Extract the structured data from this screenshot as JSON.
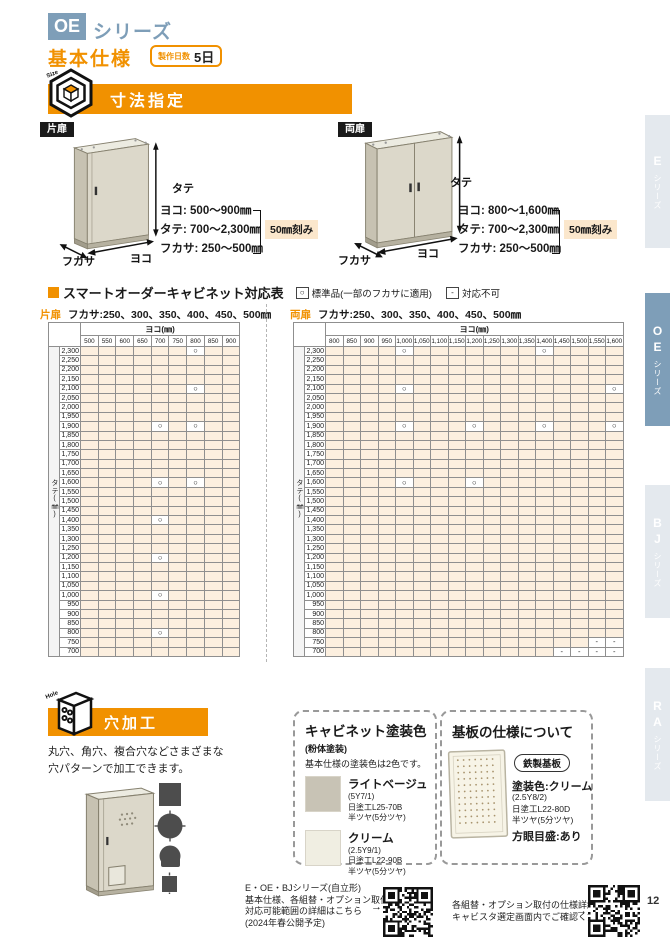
{
  "page": {
    "series_code": "OE",
    "series_suffix": "シリーズ",
    "section_title": "基本仕様",
    "lead_time_label": "製作日数",
    "lead_time_value": "5日",
    "page_number": "12"
  },
  "sidebar": {
    "tabs": [
      {
        "series": "E",
        "suffix": "シリーズ",
        "active": false
      },
      {
        "series": "OE",
        "suffix": "シリーズ",
        "active": true
      },
      {
        "series": "BJ",
        "suffix": "シリーズ",
        "active": false
      },
      {
        "series": "RA",
        "suffix": "シリーズ",
        "active": false
      }
    ]
  },
  "dimension_section": {
    "title": "寸法指定",
    "icon_label": "Size",
    "dim_labels": {
      "height": "タテ",
      "width": "ヨコ",
      "depth": "フカサ"
    },
    "single_door": {
      "label": "片扉",
      "specs": [
        "ヨコ: 500〜900㎜",
        "タテ: 700〜2,300㎜",
        "フカサ: 250〜500㎜"
      ],
      "step_note": "50㎜刻み"
    },
    "double_door": {
      "label": "両扉",
      "specs": [
        "ヨコ: 800〜1,600㎜",
        "タテ: 700〜2,300㎜",
        "フカサ: 250〜500㎜"
      ],
      "step_note": "50㎜刻み"
    }
  },
  "compatibility": {
    "title": "スマートオーダーキャビネット対応表",
    "legend": [
      {
        "symbol": "○",
        "label": "標準品(一部のフカサに適用)"
      },
      {
        "symbol": "-",
        "label": "対応不可"
      }
    ],
    "col_axis_label": "ヨコ(㎜)",
    "row_axis_label": "タテ(㎜)",
    "rows": [
      "2,300",
      "2,250",
      "2,200",
      "2,150",
      "2,100",
      "2,050",
      "2,000",
      "1,950",
      "1,900",
      "1,850",
      "1,800",
      "1,750",
      "1,700",
      "1,650",
      "1,600",
      "1,550",
      "1,500",
      "1,450",
      "1,400",
      "1,350",
      "1,300",
      "1,250",
      "1,200",
      "1,150",
      "1,100",
      "1,050",
      "1,000",
      "950",
      "900",
      "850",
      "800",
      "750",
      "700"
    ],
    "tables": [
      {
        "door_label": "片扉",
        "depth_note": "フカサ:250、300、350、400、450、500㎜",
        "columns": [
          "500",
          "550",
          "600",
          "650",
          "700",
          "750",
          "800",
          "850",
          "900"
        ],
        "marks": [
          {
            "r": "2,300",
            "c": "800",
            "s": "○"
          },
          {
            "r": "2,100",
            "c": "800",
            "s": "○"
          },
          {
            "r": "1,900",
            "c": "700",
            "s": "○"
          },
          {
            "r": "1,900",
            "c": "800",
            "s": "○"
          },
          {
            "r": "1,600",
            "c": "700",
            "s": "○"
          },
          {
            "r": "1,600",
            "c": "800",
            "s": "○"
          },
          {
            "r": "1,400",
            "c": "700",
            "s": "○"
          },
          {
            "r": "1,200",
            "c": "700",
            "s": "○"
          },
          {
            "r": "1,000",
            "c": "700",
            "s": "○"
          },
          {
            "r": "800",
            "c": "700",
            "s": "○"
          }
        ]
      },
      {
        "door_label": "両扉",
        "depth_note": "フカサ:250、300、350、400、450、500㎜",
        "columns": [
          "800",
          "850",
          "900",
          "950",
          "1,000",
          "1,050",
          "1,100",
          "1,150",
          "1,200",
          "1,250",
          "1,300",
          "1,350",
          "1,400",
          "1,450",
          "1,500",
          "1,550",
          "1,600"
        ],
        "marks": [
          {
            "r": "2,300",
            "c": "1,000",
            "s": "○"
          },
          {
            "r": "2,300",
            "c": "1,400",
            "s": "○"
          },
          {
            "r": "2,100",
            "c": "1,000",
            "s": "○"
          },
          {
            "r": "2,100",
            "c": "1,600",
            "s": "○"
          },
          {
            "r": "1,900",
            "c": "1,000",
            "s": "○"
          },
          {
            "r": "1,900",
            "c": "1,200",
            "s": "○"
          },
          {
            "r": "1,900",
            "c": "1,400",
            "s": "○"
          },
          {
            "r": "1,900",
            "c": "1,600",
            "s": "○"
          },
          {
            "r": "1,600",
            "c": "1,000",
            "s": "○"
          },
          {
            "r": "1,600",
            "c": "1,200",
            "s": "○"
          },
          {
            "r": "750",
            "c": "1,550",
            "s": "-"
          },
          {
            "r": "750",
            "c": "1,600",
            "s": "-"
          },
          {
            "r": "700",
            "c": "1,450",
            "s": "-"
          },
          {
            "r": "700",
            "c": "1,500",
            "s": "-"
          },
          {
            "r": "700",
            "c": "1,550",
            "s": "-"
          },
          {
            "r": "700",
            "c": "1,600",
            "s": "-"
          }
        ]
      }
    ]
  },
  "hole_section": {
    "title": "穴加工",
    "icon_label": "Hole",
    "description_lines": [
      "丸穴、角穴、複合穴などさまざまな",
      "穴パターンで加工できます。"
    ]
  },
  "paint_box": {
    "title": "キャビネット塗装色",
    "subtitle": "(粉体塗装)",
    "note": "基本仕様の塗装色は2色です。",
    "colors": [
      {
        "name": "ライトベージュ",
        "munsell": "(5Y7/1)",
        "paint_code": "日塗工L25-70B",
        "finish": "半ツヤ(5分ツヤ)",
        "hex": "#c8c3b5"
      },
      {
        "name": "クリーム",
        "munsell": "(2.5Y9/1)",
        "paint_code": "日塗工L22-90B",
        "finish": "半ツヤ(5分ツヤ)",
        "hex": "#f0eee2"
      }
    ]
  },
  "base_plate_box": {
    "title": "基板の仕様について",
    "badge": "鉄製基板",
    "paint_label": "塗装色:クリーム",
    "munsell": "(2.5Y8/2)",
    "paint_code": "日塗工L22-80D",
    "finish": "半ツヤ(5分ツヤ)",
    "grid_label": "方眼目盛:あり"
  },
  "footer": {
    "left_lines": [
      "E・OE・BJシリーズ(自立形)",
      "基本仕様、各組替・オプション取付の",
      "対応可能範囲の詳細はこちら",
      "(2024年春公開予定)"
    ],
    "right_lines": [
      "各組替・オプション取付の仕様詳細は",
      "キャビスタ選定画面内でご確認ください"
    ],
    "arrow": "→"
  },
  "theme": {
    "accent_orange": "#f19100",
    "active_tab_blue": "#7e9eb8",
    "inactive_tab_bg": "#e4e9ee",
    "cell_beige": "#fcefdf",
    "note_beige": "#fbe7cc"
  }
}
